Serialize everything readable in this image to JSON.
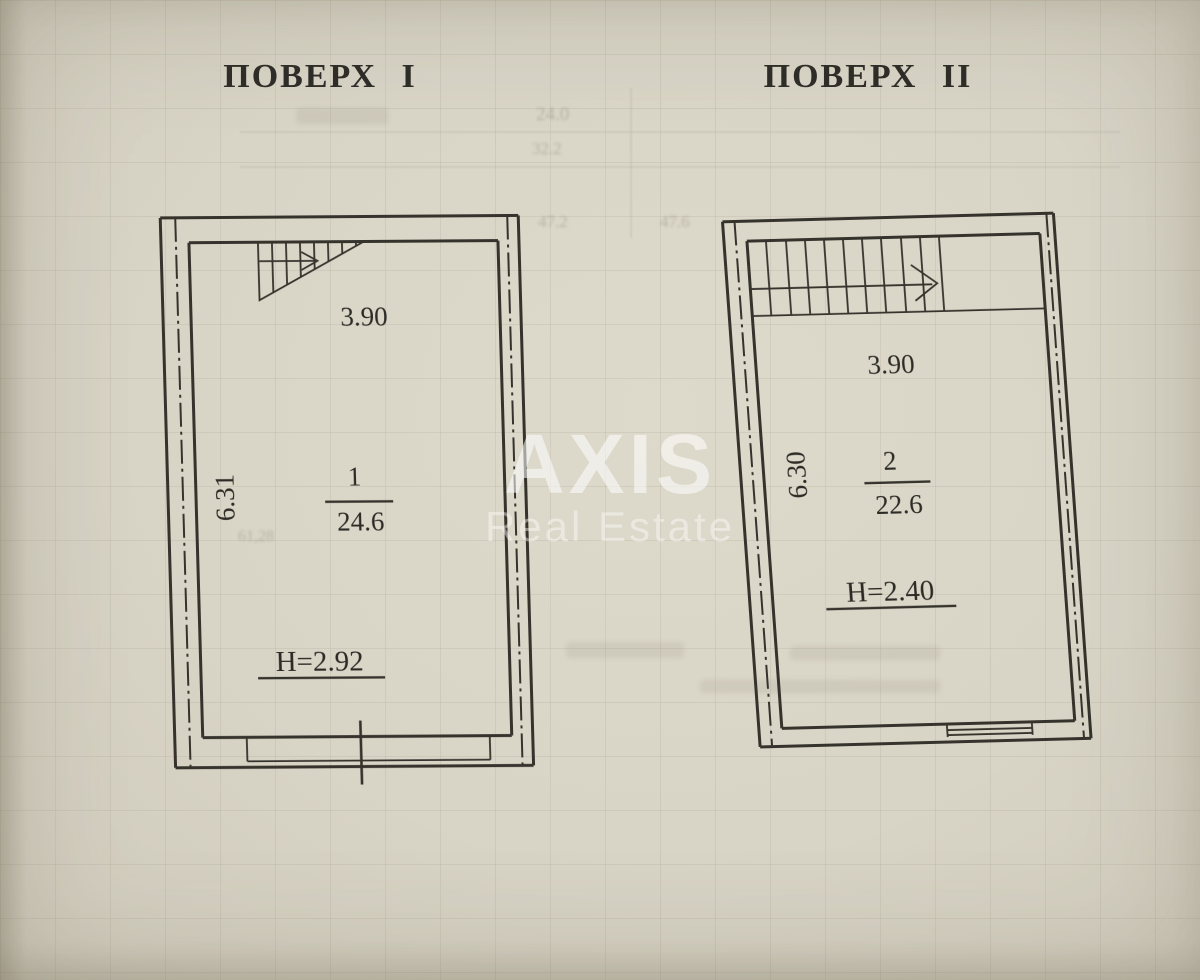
{
  "watermark": {
    "brand": "AXIS",
    "subtitle": "Real Estate"
  },
  "floors": [
    {
      "title": "ПОВЕРХ I",
      "width_m": "3.90",
      "depth_m": "6.31",
      "room_number": "1",
      "room_area_m2": "24.6",
      "ceiling_height": "H=2.92"
    },
    {
      "title": "ПОВЕРХ II",
      "width_m": "3.90",
      "depth_m": "6.30",
      "room_number": "2",
      "room_area_m2": "22.6",
      "ceiling_height": "H=2.40"
    }
  ],
  "bleedthrough": {
    "n1": "24.0",
    "n2": "32.2",
    "n3": "47.2",
    "n4": "47.6",
    "n5": "61,28"
  }
}
